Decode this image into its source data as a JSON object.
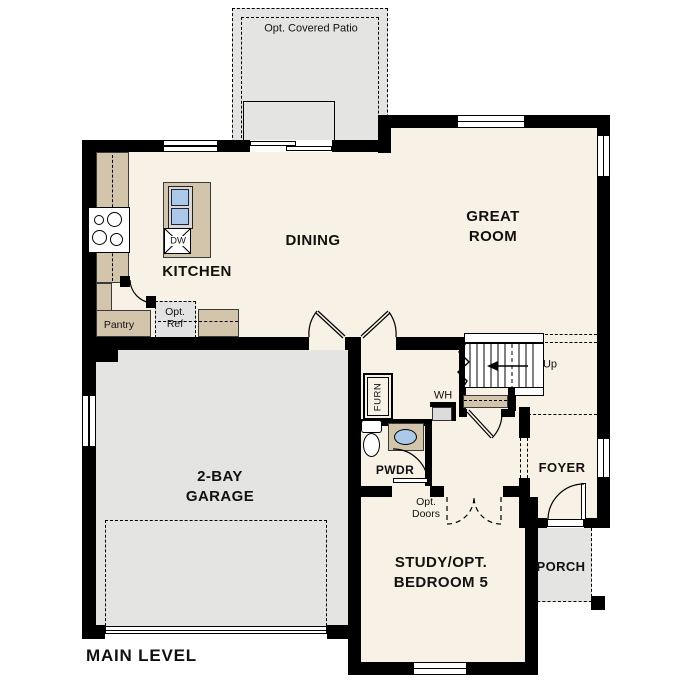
{
  "plan_title": "MAIN LEVEL",
  "rooms": {
    "patio": "Opt. Covered Patio",
    "kitchen": "KITCHEN",
    "dining": "DINING",
    "great_room": [
      "GREAT",
      "ROOM"
    ],
    "garage": [
      "2-BAY",
      "GARAGE"
    ],
    "study": [
      "STUDY/OPT.",
      "BEDROOM 5"
    ],
    "foyer": "FOYER",
    "porch": "PORCH",
    "powder": "PWDR"
  },
  "fixtures": {
    "pantry": "Pantry",
    "opt_ref": [
      "Opt.",
      "Ref"
    ],
    "dishwasher": "DW",
    "furnace": "FURN",
    "water_heater": "WH",
    "stairs_up": "Up",
    "opt_doors": [
      "Opt.",
      "Doors"
    ]
  },
  "colors": {
    "floor": "#f8f1e5",
    "concrete": "#e4e4e2",
    "counter": "#d2c5ab",
    "sink_blue": "#abc8e8",
    "wall": "#000000"
  }
}
